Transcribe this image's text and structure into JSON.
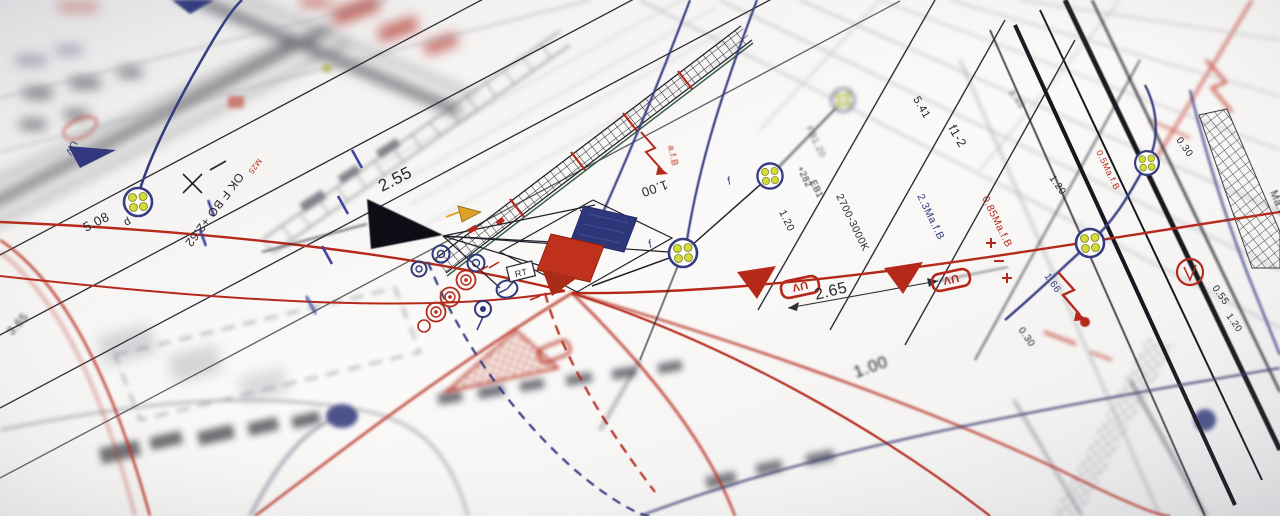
{
  "colors": {
    "paper": "#f8f7f4",
    "ink": "#24242c",
    "red": "#b5291b",
    "navy": "#303879",
    "yellow_dot": "#d3dc39"
  },
  "stamps": {
    "uv_left": "UV",
    "uv_a": "UV",
    "uv_b": "UV",
    "rt": "RT"
  },
  "labels": {
    "dim_3_65": "3.65",
    "dim_5_08": "5.08",
    "cable_d": "d",
    "note_ok": "OK F BO +2.62",
    "conduit_m25": "M25",
    "dim_2_55": "2.55",
    "dim_1_00_a": "1.00",
    "afb_small": "a.f.B",
    "f_1": "f",
    "f_2": "f",
    "fb_ref": "FB1.20",
    "plus_282": "+282",
    "eb_ref": "EB1",
    "dim_1_20_lane": "1.20",
    "kelvin": "2700-3000K",
    "dim_2_65": "2.65",
    "fixture_f1_2": "f1-2",
    "dim_5_41": "5.41",
    "maf_2_3": "2.3Ma.f.B",
    "maf_0_85": "0.85Ma.f.B",
    "dim_1_00_b": "1.00",
    "dim_3_48": "3.48",
    "dim_1_20_rail_a": "1.20",
    "dim_0_30_rail_a": "0.30",
    "maf_0_5": "0.5Ma.f.B",
    "dim_1_66": "1.66",
    "dim_0_55": "0.55",
    "dim_1_20_rail_b": "1.20",
    "dim_0_30_rail_b": "0.30",
    "maf_edge": "Ma.f.B"
  }
}
